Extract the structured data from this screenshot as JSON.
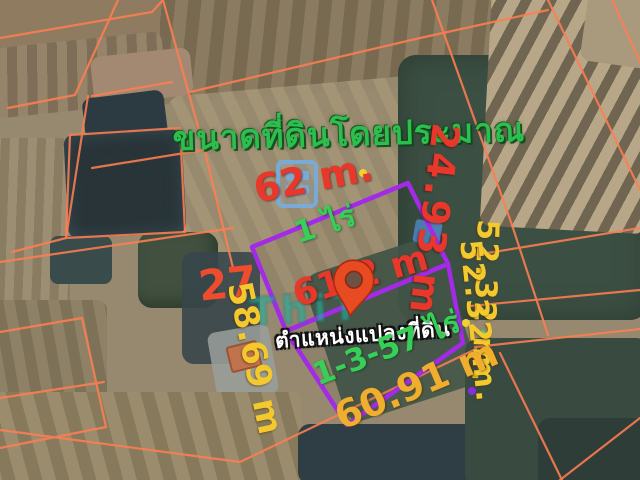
{
  "scene": {
    "description": "Aerial satellite view with annotated land plot boundaries",
    "title": "ขนาดที่ดินโดยประมาณ"
  },
  "annotations": {
    "top_edge_length": "62 m.",
    "upper_right_edge_length": "24.93 m",
    "right_edge_length": "52.32 m.",
    "right_edge_length_ghost": "52.32 m.",
    "upper_left_edge_length": "27",
    "lower_left_edge_length": "58.69 m",
    "middle_edge_length": "61.2 m",
    "upper_plot_area": "1 ไร่",
    "lower_plot_area": "1-3-57 ไร่",
    "bottom_edge_length": "60.91 m",
    "pin_caption": "ตำแหน่งแปลงที่ดิน"
  },
  "watermark": {
    "text": "ThiT",
    "logo": "building-logo-icon"
  },
  "colors": {
    "title_green": "#2dbf4e",
    "red_label": "#e8382b",
    "yellow_label": "#f3c92e",
    "gold_label": "#efae2e",
    "green_label": "#38cf58",
    "plot_outline_purple": "#a32ae6",
    "parcel_line_orange": "#ff7e52",
    "pin_red": "#e84a22",
    "watermark_teal": "#21b2a0",
    "logo_blue": "#76addf"
  }
}
